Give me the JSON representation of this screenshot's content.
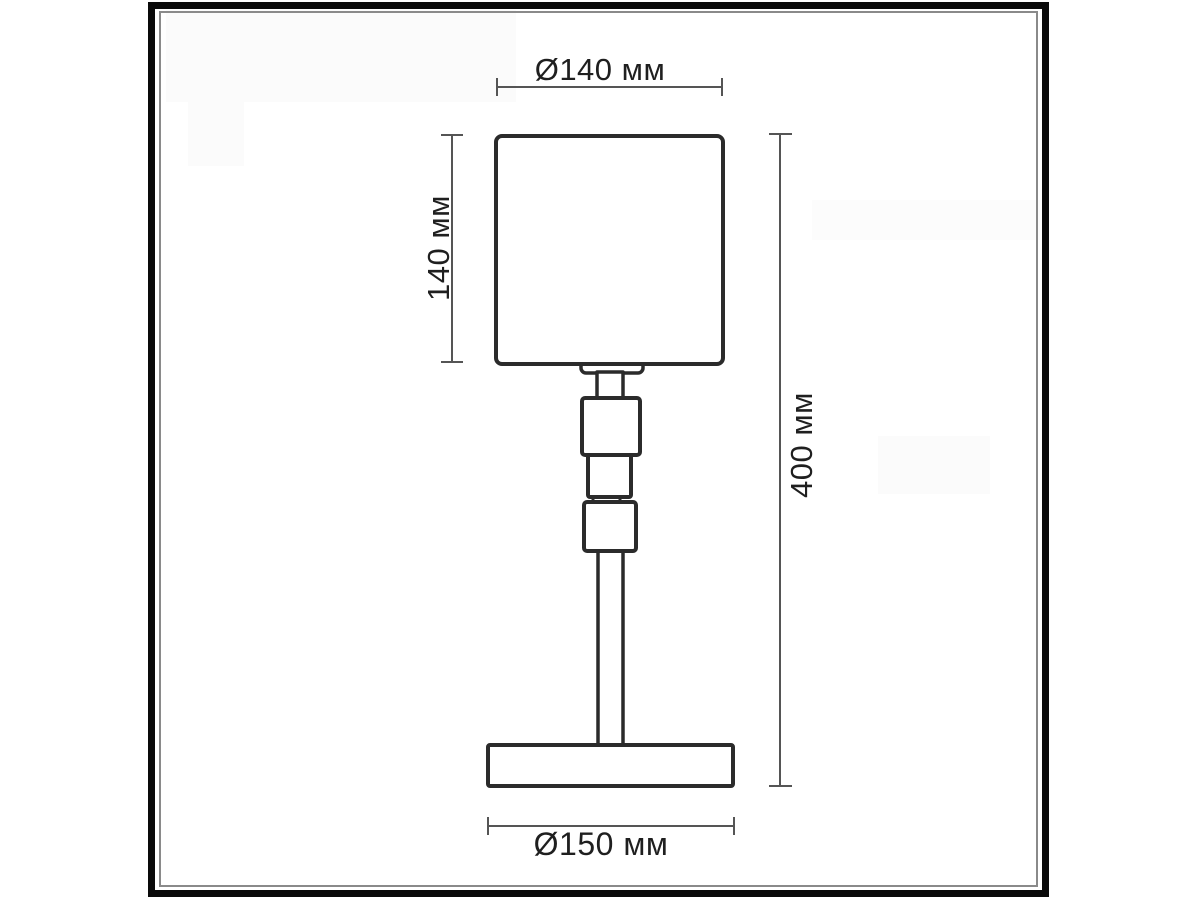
{
  "figure": {
    "kind": "technical dimension drawing",
    "subject": "table lamp elevation",
    "units": "мм",
    "labels": {
      "shade_diameter": "Ø140 мм",
      "shade_height": "140 мм",
      "total_height": "400 мм",
      "base_diameter": "Ø150 мм"
    },
    "values": {
      "shade_diameter_mm": 140,
      "shade_height_mm": 140,
      "total_height_mm": 400,
      "base_diameter_mm": 150
    },
    "colors": {
      "background": "#ffffff",
      "frame_outer": "#0a0a0a",
      "frame_inner_line": "#8a8a8a",
      "drawing_line": "#2b2b2b",
      "dimension_line": "#555555",
      "text": "#1f1f1f"
    }
  }
}
